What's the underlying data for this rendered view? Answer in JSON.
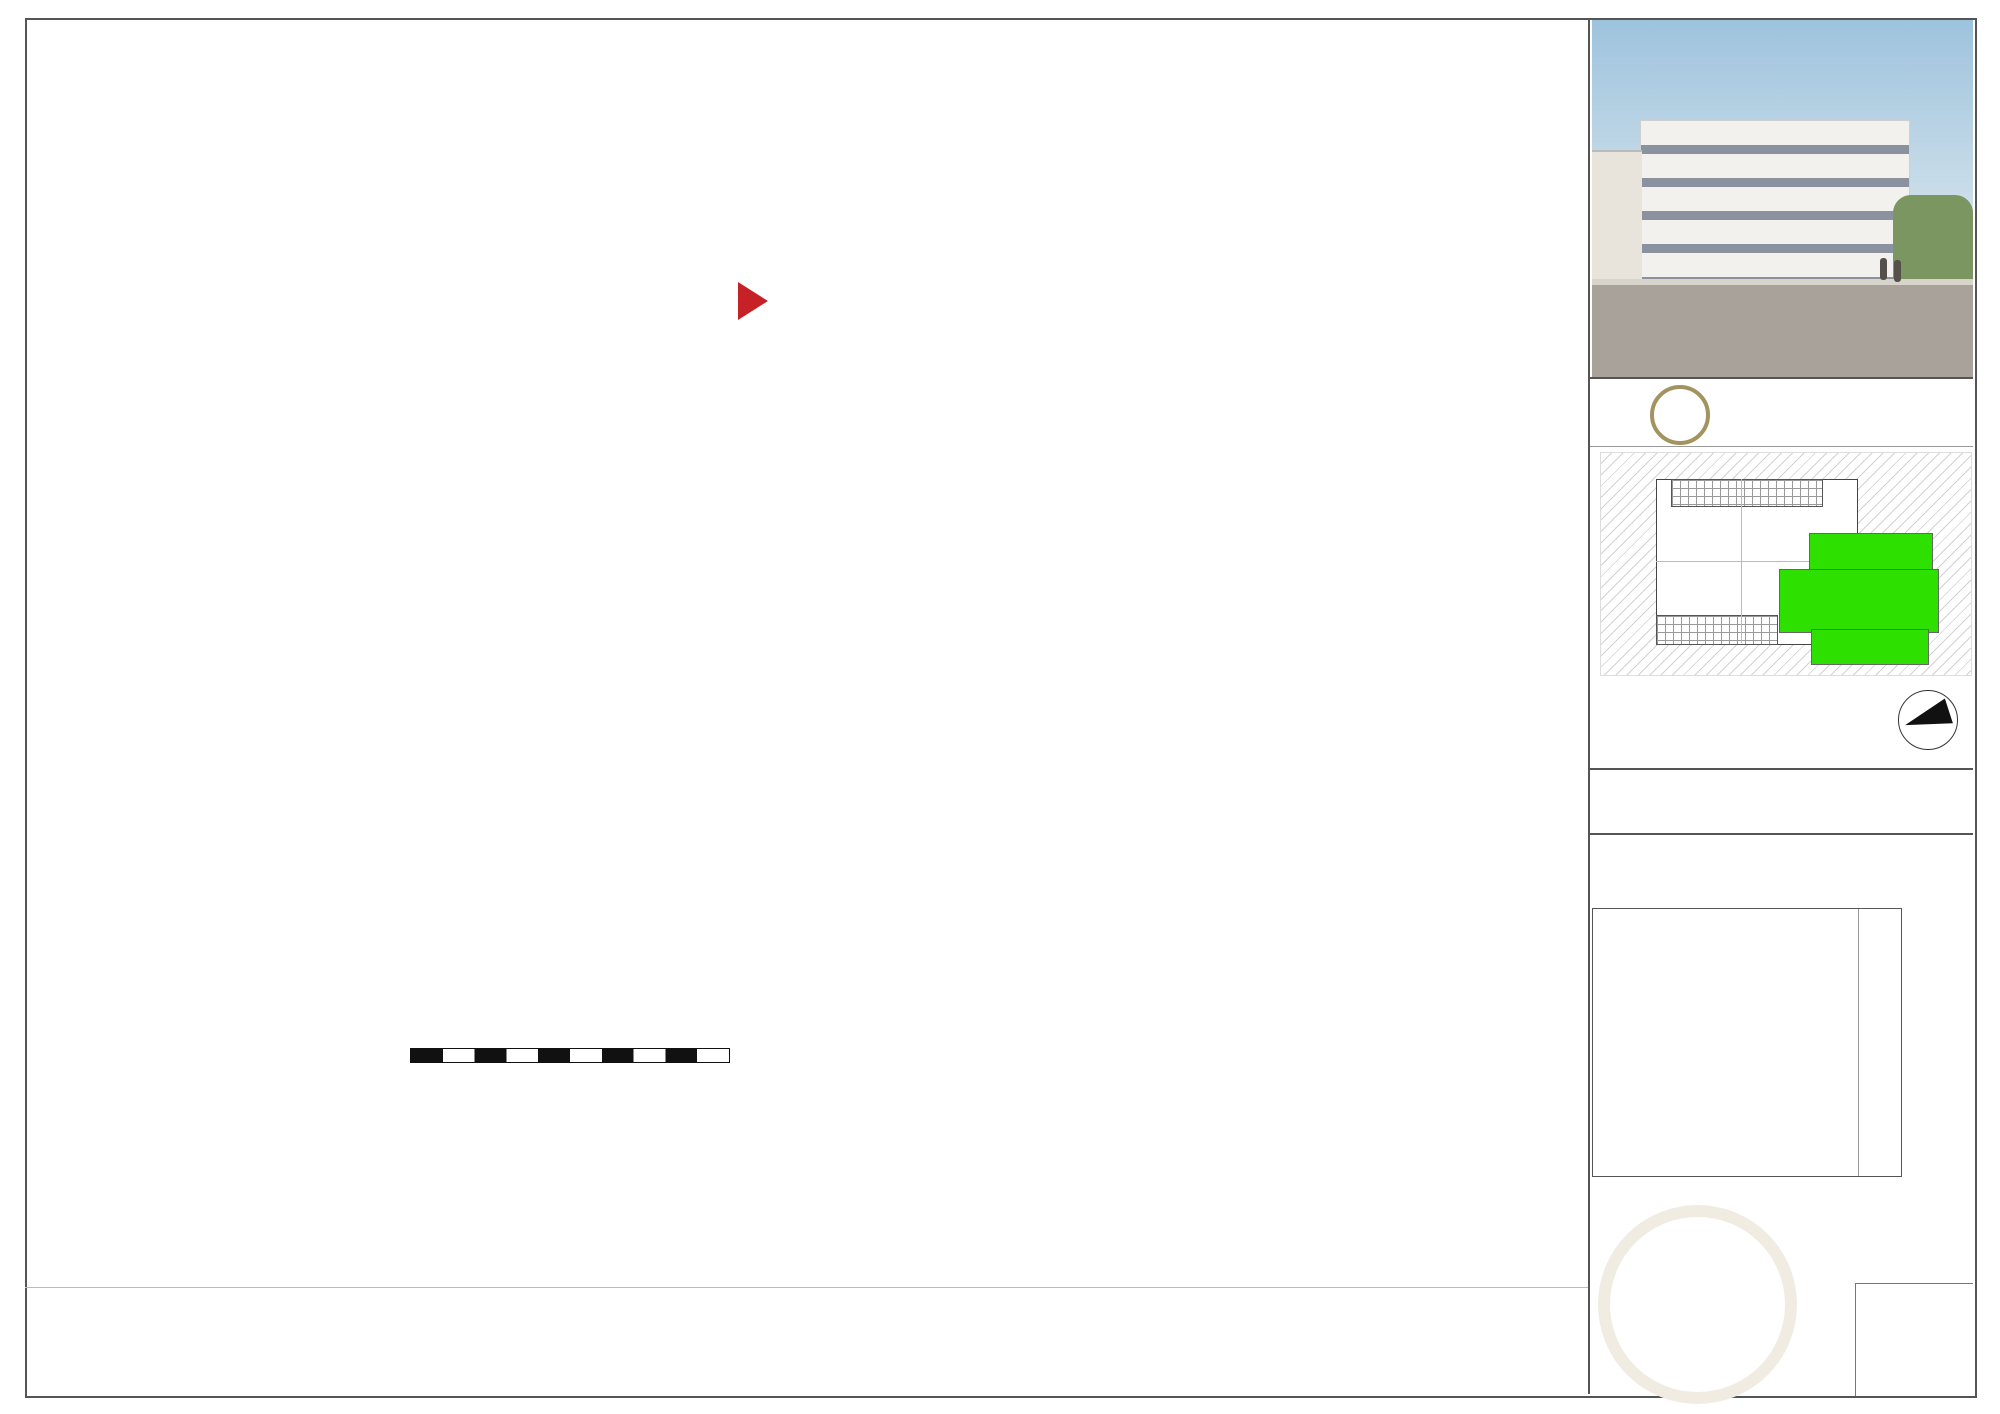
{
  "sidebar": {
    "photo_title": "RREESISDIEDNECNEC EA C\".",
    "brand_number": "21",
    "brand_name": "Cabinet Corvaja",
    "north_label": "N",
    "apartment_title": "Appartement 1201 - Type 4 -  R+12",
    "construction_lines": [
      "Construction de 123 logements",
      "Avenue de Craponne",
      "13 800 ISTRES"
    ],
    "surface_table": {
      "rows": [
        {
          "label": "HALL  --  SEJJOUURR  -  -C",
          "label2": "",
          "overlay": "",
          "value": "3496.0890 m²²",
          "vcls": ""
        },
        {
          "label": "CUUISISININEE",
          "label2": "",
          "overlay": "",
          "value": "12.7290 m²²",
          "vcls": ""
        },
        {
          "label": "CWHCAMBRE",
          "label2": "1",
          "overlay": "",
          "value": "160.280 m²²",
          "vcls": ""
        },
        {
          "label": "CSAHLALMEB  DRE  2BAINS",
          "label2": "",
          "overlay": "",
          "value": "140.2605 m²²",
          "vcls": ""
        },
        {
          "label": "1      CSAHLALMEB          DRE",
          "label2": "",
          "overlay": "",
          "value": "85.0330 m²²",
          "vcls": ""
        },
        {
          "label": "3BAINS",
          "label2": "2",
          "overlay": "",
          "value": "132.4165 m²²",
          "vcls": ""
        },
        {
          "label": "BDAEIGNASGEMENT",
          "label2": "-",
          "overlay": "",
          "value": "108.5695 m²³",
          "vcls": ""
        },
        {
          "label": "PLACARDS WCH-CAMBRE 1",
          "label2": "",
          "overlay": "",
          "value": "103.430 m²²",
          "vcls": ""
        },
        {
          "label": "SURFACE TOTALE HABITABLE",
          "label2": "",
          "overlay": "DOEHOAAMGBERMEE 2NTS",
          "value": "9985..7856 m²",
          "vcls": ""
        },
        {
          "label": "- PLACARDS",
          "label2": "",
          "overlay": "",
          "value": "",
          "vcls": ""
        },
        {
          "label": "TERRASSE",
          "label2": "",
          "overlay": "CEHLALMIEBRRE 3",
          "value": "250.6420 m²²",
          "vcls": "muted"
        },
        {
          "label": "",
          "label2": "",
          "overlay": "",
          "value": "",
          "vcls": ""
        },
        {
          "label": "SURFACE TOTALE PRIVATIVE",
          "label2": "",
          "overlay": "",
          "value": "205..6402 m²²",
          "vcls": "total"
        }
      ]
    },
    "date_label": "date:",
    "date_value": "FMévarriesr2 2002224"
  },
  "legend": {
    "items": [
      {
        "type": "gaine",
        "label": "Gaine technique",
        "swatch_text": ""
      },
      {
        "type": "terrasse",
        "label": "Terrasse",
        "swatch_text": ""
      },
      {
        "type": "pmr",
        "label": "Normes PMR",
        "swatch_text": ""
      },
      {
        "type": "soffite",
        "label": "Soffite ou Faux Plafond",
        "swatch_text": ""
      },
      {
        "type": "placard",
        "label": "Pl. : placard",
        "swatch_text": "Pl."
      },
      {
        "type": "tge",
        "label": "TGE: table au électrique",
        "swatch_text": "TGE"
      },
      {
        "type": "ce",
        "label": "Chaudière électrique",
        "swatch_text": "CE"
      },
      {
        "type": "eau",
        "label": "descente Eau Pluvial",
        "swatch_text": ""
      },
      {
        "type": "tole",
        "label": "Tôle métal perforé",
        "swatch_text": ""
      },
      {
        "type": "garde",
        "label": "Garde-corps",
        "swatch_text": ""
      }
    ]
  },
  "scale_bar": {
    "numbers": [
      "0",
      "1",
      "2",
      "3",
      "4",
      "5"
    ]
  },
  "nota_lines": [
    "NOTA: Des modifications sont suceptibles d'être apportées à ce plan en fonction des nécessités techniques lors de la réalisation, tant en ce qui concerne les dimensions libres que les",
    "équipements. Les surfaces indiquées sont approximatives. Les côtes et les surfaces indiquées sont données moyennant la prise en compte d'une tolérance pour la réalisation. Les retombées,",
    "soffites, faux-plafonds, canalisations, ballons d'eau chaude ainsi que l'implantation des équipements sont figurés à titre indicatif."
  ],
  "plan": {
    "labels": [
      [
        "120x220",
        322,
        120,
        9,
        "red",
        0
      ],
      [
        "MI 2",
        405,
        110,
        10,
        "",
        -90
      ],
      [
        "83x204",
        395,
        112,
        7,
        "",
        -90
      ],
      [
        "Sdb / Wc",
        511,
        166,
        16,
        "",
        0
      ],
      [
        "6.60 m²",
        511,
        189,
        13,
        "",
        0
      ],
      [
        "Carrelage",
        513,
        209,
        12,
        "italic",
        0
      ],
      [
        "80x130",
        436,
        206,
        8,
        "red",
        -90
      ],
      [
        "80x130",
        576,
        206,
        8,
        "red",
        -90
      ],
      [
        "90x120",
        634,
        157,
        7,
        "",
        -90
      ],
      [
        "TGE",
        285,
        232,
        8,
        "",
        -90
      ],
      [
        "MI 1",
        362,
        228,
        10,
        "",
        -90
      ],
      [
        "93x204",
        373,
        228,
        7,
        "",
        -90
      ],
      [
        "204",
        354,
        283,
        17,
        "",
        0
      ],
      [
        "Ngf +14.91(+ 5.59)",
        790,
        144,
        14,
        "",
        0
      ],
      [
        "34",
        838,
        104,
        10,
        "",
        0
      ],
      [
        "33",
        864,
        104,
        10,
        "",
        0
      ],
      [
        "32",
        897,
        104,
        10,
        "",
        0
      ],
      [
        "31",
        919,
        92,
        10,
        "",
        0
      ],
      [
        "Bande",
        821,
        97,
        7,
        "",
        -90
      ],
      [
        "MI 5",
        795,
        95,
        8,
        "",
        -90
      ],
      [
        "93x204",
        784,
        97,
        7,
        "",
        -90
      ],
      [
        "ENTREE E",
        686,
        301,
        20,
        "redbold",
        0
      ],
      [
        "TR",
        786,
        303,
        20,
        "redbold",
        0
      ],
      [
        "75",
        808,
        300,
        26,
        "redbold",
        0
      ],
      [
        "EE",
        836,
        303,
        20,
        "redbold",
        0
      ],
      [
        "297",
        861,
        293,
        10,
        "",
        0
      ],
      [
        "222",
        884,
        315,
        10,
        "",
        0
      ],
      [
        "30",
        921,
        309,
        8,
        "",
        -90
      ],
      [
        "Wc",
        909,
        219,
        15,
        "",
        0
      ],
      [
        "151",
        938,
        215,
        8,
        "",
        -90
      ],
      [
        "146",
        913,
        238,
        10,
        "",
        0
      ],
      [
        "1.88",
        967,
        201,
        10,
        "",
        -75
      ],
      [
        "1.43",
        994,
        227,
        10,
        "",
        0
      ],
      [
        "5",
        1047,
        213,
        10,
        "",
        0
      ],
      [
        "W1-9c3",
        1038,
        244,
        10,
        "",
        0
      ],
      [
        "Sdb 1",
        1025,
        270,
        15,
        "",
        0
      ],
      [
        "370",
        989,
        282,
        9,
        "",
        -90
      ],
      [
        "Cellier",
        1076,
        177,
        15,
        "",
        0
      ],
      [
        "2.01",
        1108,
        213,
        10,
        "",
        0
      ],
      [
        "CE",
        1127,
        258,
        12,
        "",
        0
      ],
      [
        "LVF",
        1139,
        334,
        11,
        "italic",
        -80
      ],
      [
        "+",
        976,
        170,
        11,
        "",
        0
      ],
      [
        "+",
        1069,
        293,
        11,
        "",
        0
      ],
      [
        "+",
        483,
        379,
        11,
        "",
        0
      ],
      [
        "SG",
        547,
        368,
        9,
        "",
        0
      ],
      [
        "EDF",
        605,
        368,
        9,
        "",
        0
      ],
      [
        "AEP",
        652,
        368,
        9,
        "",
        0
      ],
      [
        "TEL",
        688,
        368,
        9,
        "",
        0
      ],
      [
        "AEP",
        646,
        378,
        10,
        "blue",
        0
      ],
      [
        "EDF",
        694,
        378,
        10,
        "red",
        0
      ],
      [
        "GAZ",
        737,
        378,
        10,
        "orange",
        0
      ],
      [
        "TEL",
        784,
        375,
        10,
        "green",
        0
      ],
      [
        "SG",
        816,
        376,
        11,
        "",
        0
      ],
      [
        "TGE",
        791,
        359,
        8,
        "",
        0
      ],
      [
        "TGE",
        868,
        369,
        8,
        "",
        0
      ],
      [
        "CE",
        792,
        404,
        14,
        "",
        0
      ],
      [
        "70",
        721,
        408,
        9,
        "",
        -90
      ],
      [
        "68",
        756,
        419,
        9,
        "",
        -90
      ],
      [
        "PI.",
        703,
        427,
        10,
        "",
        0
      ],
      [
        "375",
        833,
        415,
        9,
        "",
        -90
      ],
      [
        "PI.",
        818,
        428,
        10,
        "",
        0
      ],
      [
        "65",
        869,
        404,
        11,
        "",
        0
      ],
      [
        "Pl.",
        873,
        428,
        10,
        "",
        0
      ],
      [
        "2.48",
        923,
        435,
        10,
        "",
        -90
      ],
      [
        "2.43",
        968,
        403,
        10,
        "",
        0
      ],
      [
        "F",
        988,
        406,
        10,
        "",
        0
      ],
      [
        "CU",
        1064,
        408,
        9,
        "",
        0
      ],
      [
        "LC",
        1032,
        360,
        12,
        "",
        0
      ],
      [
        "Cuisine",
        1048,
        361,
        13,
        "red",
        0
      ],
      [
        "1.80",
        1101,
        404,
        9,
        "",
        0
      ],
      [
        "EV",
        1141,
        407,
        10,
        "italic",
        -20
      ],
      [
        "LV",
        1178,
        407,
        10,
        "",
        0
      ],
      [
        "Pl.",
        518,
        398,
        11,
        "",
        0
      ],
      [
        "V",
        273,
        385,
        10,
        "",
        0
      ],
      [
        "LL",
        313,
        432,
        10,
        "",
        0
      ],
      [
        "F",
        313,
        468,
        10,
        "",
        0
      ],
      [
        "2.18",
        404,
        436,
        10,
        "",
        -90
      ],
      [
        "Sdb 2",
        447,
        445,
        16,
        "",
        0
      ],
      [
        "120x90",
        443,
        478,
        8,
        "blue",
        0
      ],
      [
        "247",
        449,
        484,
        10,
        "",
        0
      ],
      [
        "7",
        493,
        483,
        10,
        "",
        0
      ],
      [
        "2.44",
        529,
        491,
        12,
        "",
        0
      ],
      [
        "5",
        580,
        484,
        10,
        "",
        0
      ],
      [
        "2.28",
        496,
        444,
        10,
        "",
        -90
      ],
      [
        "Sdb",
        533,
        445,
        15,
        "",
        0
      ],
      [
        "Dgmt",
        659,
        460,
        15,
        "",
        0
      ],
      [
        "478",
        668,
        482,
        10,
        "",
        0
      ],
      [
        "2.18",
        654,
        491,
        12,
        "",
        0
      ],
      [
        "115",
        709,
        469,
        8,
        "",
        -90
      ],
      [
        "20",
        708,
        487,
        9,
        "",
        0
      ],
      [
        "1.20",
        753,
        471,
        9,
        "",
        -90
      ],
      [
        "Dégagt.",
        806,
        461,
        13,
        "",
        0
      ],
      [
        "2.471",
        818,
        482,
        10,
        "",
        0
      ],
      [
        "185",
        871,
        482,
        10,
        "",
        0
      ],
      [
        "5",
        892,
        488,
        10,
        "",
        0
      ],
      [
        "4.28",
        1016,
        491,
        11,
        "",
        0
      ],
      [
        "3.21",
        1256,
        490,
        11,
        "",
        0
      ],
      [
        "T4",
        1108,
        518,
        22,
        "",
        0
      ],
      [
        "98.76 m²",
        1092,
        549,
        26,
        "",
        0
      ],
      [
        "Séjour / Cuisine",
        1112,
        574,
        17,
        "",
        0
      ],
      [
        "Séjour/ Repas",
        1209,
        588,
        15,
        "",
        0
      ],
      [
        "578",
        989,
        571,
        9,
        "",
        -90
      ],
      [
        "448",
        1259,
        611,
        9,
        "",
        -90
      ],
      [
        "5.70",
        1304,
        577,
        11,
        "italic",
        -75
      ],
      [
        "20",
        966,
        665,
        10,
        "",
        0
      ],
      [
        "567",
        1112,
        665,
        10,
        "",
        0
      ],
      [
        "5.94",
        1186,
        686,
        12,
        "",
        0
      ],
      [
        "20",
        1003,
        700,
        10,
        "",
        0
      ],
      [
        "Chambre 2",
        658,
        581,
        15,
        "",
        0
      ],
      [
        "Chambre 1",
        601,
        599,
        13,
        "",
        0
      ],
      [
        "Chambre 3",
        840,
        581,
        15,
        "",
        0
      ],
      [
        "Chambre 2",
        783,
        599,
        13,
        "",
        0
      ],
      [
        "Chambre 3",
        887,
        599,
        13,
        "",
        0
      ],
      [
        "Chambre 1",
        515,
        634,
        15,
        "",
        0
      ],
      [
        "381",
        402,
        654,
        9,
        "",
        -90
      ],
      [
        "345",
        456,
        690,
        10,
        "",
        0
      ],
      [
        "3.78",
        497,
        660,
        10,
        "",
        -70
      ],
      [
        "3.39",
        525,
        717,
        12,
        "",
        0
      ],
      [
        "7",
        579,
        690,
        10,
        "",
        0
      ],
      [
        "280",
        661,
        689,
        10,
        "",
        0
      ],
      [
        "5",
        648,
        734,
        10,
        "",
        0
      ],
      [
        "381",
        721,
        654,
        9,
        "",
        -90
      ],
      [
        "2.70",
        748,
        715,
        12,
        "",
        0
      ],
      [
        "7",
        762,
        690,
        10,
        "",
        0
      ],
      [
        "270",
        840,
        689,
        10,
        "",
        0
      ],
      [
        "5",
        824,
        734,
        10,
        "",
        0
      ],
      [
        "2.55",
        907,
        717,
        12,
        "",
        0
      ],
      [
        "15",
        948,
        690,
        10,
        "",
        0
      ],
      [
        "Terrasse",
        938,
        824,
        15,
        "",
        0
      ],
      [
        "Terrasse",
        1071,
        847,
        13,
        "",
        0
      ],
      [
        "E 5b",
        271,
        770,
        12,
        "",
        0
      ],
      [
        "VRE",
        291,
        753,
        8,
        "gray",
        0
      ],
      [
        "EP",
        312,
        921,
        15,
        "navy",
        0
      ]
    ]
  }
}
